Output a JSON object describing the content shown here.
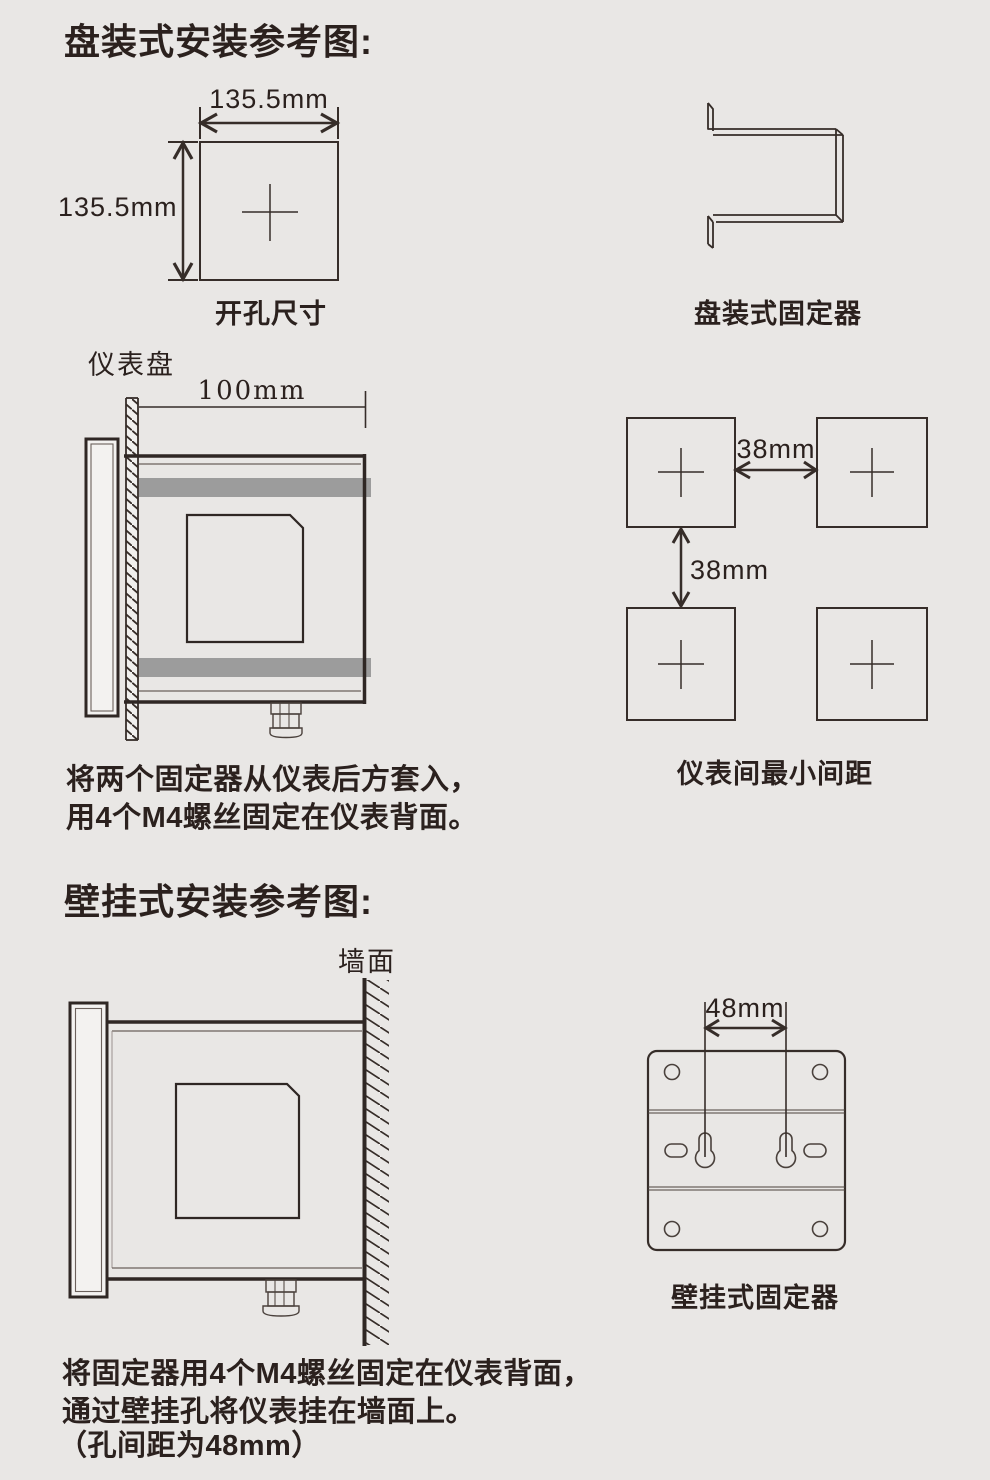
{
  "page": {
    "bg_color": "#e9e7e5",
    "ink_color": "#2b211e",
    "line_color": "#362d29",
    "bar_color": "#9c9c9c"
  },
  "panel_section": {
    "title": "盘装式安装参考图:",
    "cutout": {
      "width_label": "135.5mm",
      "height_label": "135.5mm",
      "caption": "开孔尺寸"
    },
    "bracket_caption": "盘装式固定器",
    "side_view": {
      "panel_label": "仪表盘",
      "depth_label": "100mm"
    },
    "spacing": {
      "horizontal_label": "38mm",
      "vertical_label": "38mm",
      "caption": "仪表间最小间距"
    },
    "note_line1": "将两个固定器从仪表后方套入，",
    "note_line2": "用4个M4螺丝固定在仪表背面。"
  },
  "wall_section": {
    "title": "壁挂式安装参考图:",
    "wall_label": "墙面",
    "bracket": {
      "hole_pitch_label": "48mm",
      "caption": "壁挂式固定器"
    },
    "note_line1": "将固定器用4个M4螺丝固定在仪表背面，",
    "note_line2": "通过壁挂孔将仪表挂在墙面上。",
    "note_line3": "（孔间距为48mm）"
  }
}
